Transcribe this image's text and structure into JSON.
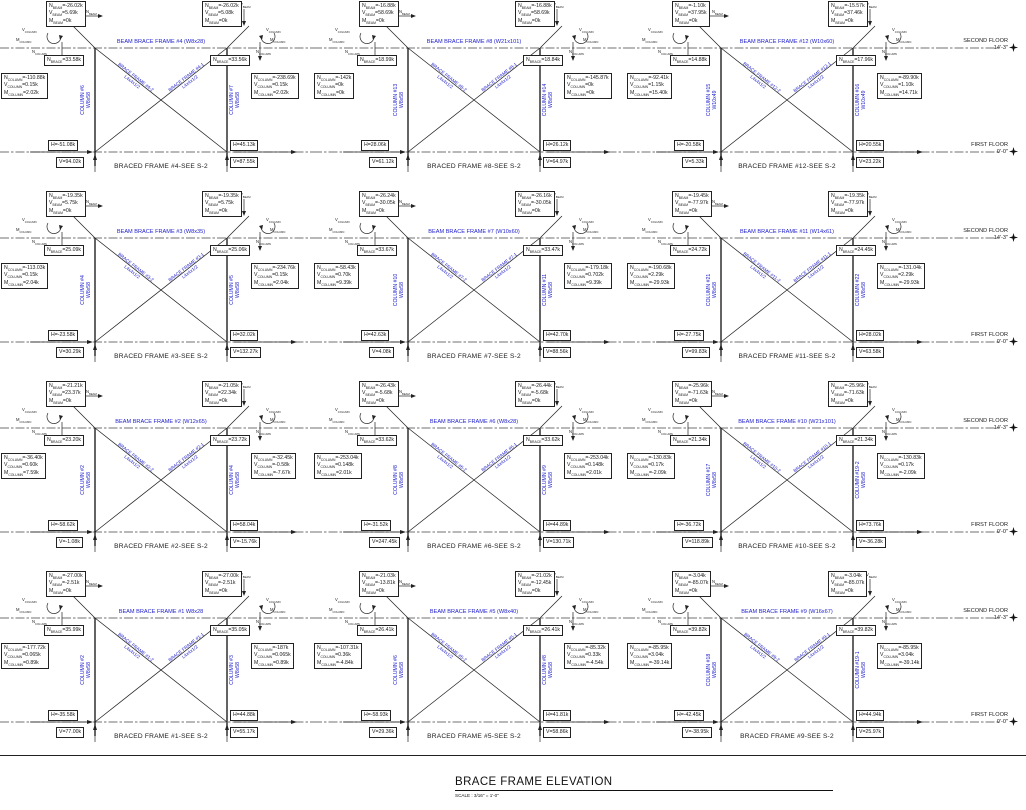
{
  "colors": {
    "label_blue": "#2222cc",
    "line_black": "#222222"
  },
  "sheet": {
    "title": "BRACE FRAME ELEVATION",
    "scale": "SCALE : 3/16\" = 1'-0\""
  },
  "floors": {
    "second": "SECOND FLOOR",
    "second_elev": "14'-3\"",
    "first": "FIRST FLOOR",
    "first_elev": "0'-0\""
  },
  "symbols": {
    "v_beam": "V_BEAM",
    "n_beam": "N_BEAM",
    "v_column": "V_COLUMN",
    "m_column": "M_COLUMN",
    "n_column": "N_COLUMN"
  },
  "frames": [
    {
      "beam_label": "BEAM BRACE FRAME #4 (W8x28)",
      "caption": "BRACED FRAME #4-SEE S-2",
      "left_column_label": "COLUMN #6",
      "left_column_size": "W8x58",
      "right_column_label": "COLUMN #7",
      "right_column_size": "W8x58",
      "left_brace_label": "BRACE FRAME #4-2",
      "left_brace_size": "L4x4x1/2",
      "right_brace_label": "BRACE FRAME #4-1",
      "right_brace_size": "L4x4x1/2",
      "beam_box_left": [
        "N_BEAM=-26.02k",
        "V_BEAM=5.69k",
        "M_BEAM=0k"
      ],
      "beam_box_right": [
        "N_BEAM=-26.02k",
        "V_BEAM=5.08k",
        "M_BEAM=0k"
      ],
      "brace_left": "N_BRACE=33.58k",
      "brace_right": "N_BRACE=33.56k",
      "column_box_left": [
        "N_COLUMN=-110.88k",
        "V_COLUMN=0.15k",
        "M_COLUMN=2.02k"
      ],
      "column_box_right": [
        "N_COLUMN=-238.69k",
        "V_COLUMN=0.15k",
        "M_COLUMN=2.02k"
      ],
      "h_left": "H=-51.08k",
      "h_right": "H=45.13k",
      "v_left": "V=94.02k",
      "v_right": "V=87.55k"
    },
    {
      "beam_label": "BEAM BRACE FRAME #8 (W21x101)",
      "caption": "BRACED FRAME #8-SEE S-2",
      "left_column_label": "COLUMN #13",
      "left_column_size": "W8x58",
      "right_column_label": "COLUMN #14",
      "right_column_size": "W8x58",
      "left_brace_label": "BRACE FRAME #8-2",
      "left_brace_size": "L4x4x1/2",
      "right_brace_label": "BRACE FRAME #8-1",
      "right_brace_size": "L4x4x1/2",
      "beam_box_left": [
        "N_BEAM=-16.88k",
        "V_BEAM=58.69k",
        "M_BEAM=0k"
      ],
      "beam_box_right": [
        "N_BEAM=-16.88k",
        "V_BEAM=58.69k",
        "M_BEAM=0k"
      ],
      "brace_left": "N_BRACE=18.99k",
      "brace_right": "N_BRACE=18.84k",
      "column_box_left": [
        "N_COLUMN=-142k",
        "V_COLUMN=0k",
        "M_COLUMN=0k"
      ],
      "column_box_right": [
        "N_COLUMN=-145.87k",
        "V_COLUMN=0k",
        "M_COLUMN=0k"
      ],
      "h_left": "H=28.06k",
      "h_right": "H=26.12k",
      "v_left": "V=61.12k",
      "v_right": "V=64.97k"
    },
    {
      "beam_label": "BEAM BRACE FRAME #12 (W10x60)",
      "caption": "BRACED FRAME #12-SEE S-2",
      "left_column_label": "COLUMN #15",
      "left_column_size": "W10x49",
      "right_column_label": "COLUMN #16",
      "right_column_size": "W10x49",
      "left_brace_label": "BRACE FRAME #12-2",
      "left_brace_size": "L4x4x1/2",
      "right_brace_label": "BRACE FRAME #12-1",
      "right_brace_size": "L4x4x1/2",
      "beam_box_left": [
        "N_BEAM=-1.10k",
        "V_BEAM=37.95k",
        "M_BEAM=0k"
      ],
      "beam_box_right": [
        "N_BEAM=-15.57k",
        "V_BEAM=37.46k",
        "M_BEAM=0k"
      ],
      "brace_left": "N_BRACE=14.88k",
      "brace_right": "N_BRACE=17.96k",
      "column_box_left": [
        "N_COLUMN=-92.41k",
        "V_COLUMN=1.15k",
        "M_COLUMN=15.40k"
      ],
      "column_box_right": [
        "N_COLUMN=-89.90k",
        "V_COLUMN=1.10k",
        "M_COLUMN=14.71k"
      ],
      "h_left": "H=-20.58k",
      "h_right": "H=20.55k",
      "v_left": "V=5.33k",
      "v_right": "V=23.22k"
    },
    {
      "beam_label": "BEAM BRACE FRAME #3 (W8x35)",
      "caption": "BRACED FRAME #3-SEE S-2",
      "left_column_label": "COLUMN #4",
      "left_column_size": "W8x58",
      "right_column_label": "COLUMN #5",
      "right_column_size": "W8x58",
      "left_brace_label": "BRACE FRAME #3-2",
      "left_brace_size": "L4x4x1/2",
      "right_brace_label": "BRACE FRAME #3-1",
      "right_brace_size": "L4x4x1/2",
      "beam_box_left": [
        "N_BEAM=-19.35k",
        "V_BEAM=5.75k",
        "M_BEAM=0k"
      ],
      "beam_box_right": [
        "N_BEAM=-19.35k",
        "V_BEAM=5.75k",
        "M_BEAM=0k"
      ],
      "brace_left": "N_BRACE=25.09k",
      "brace_right": "N_BRACE=25.06k",
      "column_box_left": [
        "N_COLUMN=-113.03k",
        "V_COLUMN=0.15k",
        "M_COLUMN=2.04k"
      ],
      "column_box_right": [
        "N_COLUMN=-234.76k",
        "V_COLUMN=0.15k",
        "M_COLUMN=2.04k"
      ],
      "h_left": "H=-23.58k",
      "h_right": "H=32.02k",
      "v_left": "V=30.29k",
      "v_right": "V=132.27k"
    },
    {
      "beam_label": "BEAM BRACE FRAME #7 (W10x60)",
      "caption": "BRACED FRAME #7-SEE S-2",
      "left_column_label": "COLUMN #10",
      "left_column_size": "W8x58",
      "right_column_label": "COLUMN #11",
      "right_column_size": "W8x58",
      "left_brace_label": "BRACE FRAME #7-2",
      "left_brace_size": "L4x4x1/2",
      "right_brace_label": "BRACE FRAME #7-1",
      "right_brace_size": "L4x4x1/2",
      "beam_box_left": [
        "N_BEAM=-26.24k",
        "V_BEAM=-30.05k",
        "M_BEAM=0k"
      ],
      "beam_box_right": [
        "N_BEAM=-26.16k",
        "V_BEAM=-30.05k",
        "M_BEAM=0k"
      ],
      "brace_left": "N_BRACE=33.67k",
      "brace_right": "N_BRACE=33.47k",
      "column_box_left": [
        "N_COLUMN=-58.43k",
        "V_COLUMN=0.70k",
        "M_COLUMN=9.39k"
      ],
      "column_box_right": [
        "N_COLUMN=-179.18k",
        "V_COLUMN=0.702k",
        "M_COLUMN=9.39k"
      ],
      "h_left": "H=42.63k",
      "h_right": "H=42.70k",
      "v_left": "V=4.08k",
      "v_right": "V=88.56k"
    },
    {
      "beam_label": "BEAM BRACE FRAME #11 (W14x61)",
      "caption": "BRACED FRAME #11-SEE S-2",
      "left_column_label": "COLUMN #21",
      "left_column_size": "W8x58",
      "right_column_label": "COLUMN #22",
      "right_column_size": "W8x58",
      "left_brace_label": "BRACE FRAME #11-2",
      "left_brace_size": "L4x4x1/2",
      "right_brace_label": "BRACE FRAME #11-1",
      "right_brace_size": "L4x4x1/2",
      "beam_box_left": [
        "N_BEAM=-19.45k",
        "V_BEAM=-77.97k",
        "M_BEAM=0k"
      ],
      "beam_box_right": [
        "N_BEAM=-19.35k",
        "V_BEAM=-77.97k",
        "M_BEAM=0k"
      ],
      "brace_left": "N_BRACE=24.72k",
      "brace_right": "N_BRACE=24.45k",
      "column_box_left": [
        "N_COLUMN=-190.68k",
        "V_COLUMN=2.29k",
        "M_COLUMN=-29.93k"
      ],
      "column_box_right": [
        "N_COLUMN=-131.04k",
        "V_COLUMN=2.29k",
        "M_COLUMN=-29.93k"
      ],
      "h_left": "H=-27.75k",
      "h_right": "H=28.02k",
      "v_left": "V=99.83k",
      "v_right": "V=63.58k"
    },
    {
      "beam_label": "BEAM BRACE FRAME #2 (W12x65)",
      "caption": "BRACED FRAME #2-SEE S-2",
      "left_column_label": "COLUMN #2",
      "left_column_size": "W8x58",
      "right_column_label": "COLUMN #4",
      "right_column_size": "W8x58",
      "left_brace_label": "BRACE FRAME #2-2",
      "left_brace_size": "L4x4x1/2",
      "right_brace_label": "BRACE FRAME #2-1",
      "right_brace_size": "L4x4x1/2",
      "beam_box_left": [
        "N_BEAM=-21.21k",
        "V_BEAM=23.37k",
        "M_BEAM=0k"
      ],
      "beam_box_right": [
        "N_BEAM=-21.05k",
        "V_BEAM=22.34k",
        "M_BEAM=0k"
      ],
      "brace_left": "N_BRACE=23.20k",
      "brace_right": "N_BRACE=23.72k",
      "column_box_left": [
        "N_COLUMN=-36.40k",
        "V_COLUMN=0.60k",
        "M_COLUMN=7.59k"
      ],
      "column_box_right": [
        "N_COLUMN=-32.45k",
        "V_COLUMN=-0.58k",
        "M_COLUMN=-7.67k"
      ],
      "h_left": "H=-58.62k",
      "h_right": "H=58.04k",
      "v_left": "V=-1.08k",
      "v_right": "V=-15.76k"
    },
    {
      "beam_label": "BEAM BRACE FRAME #6 (W8x28)",
      "caption": "BRACED FRAME #6-SEE S-2",
      "left_column_label": "COLUMN #8",
      "left_column_size": "W8x58",
      "right_column_label": "COLUMN #9",
      "right_column_size": "W8x58",
      "left_brace_label": "BRACE FRAME #6-2",
      "left_brace_size": "L4x4x1/2",
      "right_brace_label": "BRACE FRAME #6-1",
      "right_brace_size": "L4x4x1/2",
      "beam_box_left": [
        "N_BEAM=-26.43k",
        "V_BEAM=-5.68k",
        "M_BEAM=0k"
      ],
      "beam_box_right": [
        "N_BEAM=-26.44k",
        "V_BEAM=-5.68k",
        "M_BEAM=0k"
      ],
      "brace_left": "N_BRACE=33.62k",
      "brace_right": "N_BRACE=33.62k",
      "column_box_left": [
        "N_COLUMN=-253.04k",
        "V_COLUMN=0.148k",
        "M_COLUMN=2.01k"
      ],
      "column_box_right": [
        "N_COLUMN=-253.04k",
        "V_COLUMN=0.148k",
        "M_COLUMN=2.01k"
      ],
      "h_left": "H=-31.52k",
      "h_right": "H=44.89k",
      "v_left": "V=247.45k",
      "v_right": "V=130.71k"
    },
    {
      "beam_label": "BEAM BRACE FRAME #10 (W21x101)",
      "caption": "BRACED FRAME #10-SEE S-2",
      "left_column_label": "COLUMN #17",
      "left_column_size": "W8x58",
      "right_column_label": "COLUMN #19-2",
      "right_column_size": "W8x58",
      "left_brace_label": "BRACE FRAME #10-2",
      "left_brace_size": "L4x4x1/2",
      "right_brace_label": "BRACE FRAME #10-1",
      "right_brace_size": "L4x4x1/2",
      "beam_box_left": [
        "N_BEAM=-25.96k",
        "V_BEAM=-71.63k",
        "M_BEAM=0k"
      ],
      "beam_box_right": [
        "N_BEAM=-25.96k",
        "V_BEAM=-71.63k",
        "M_BEAM=0k"
      ],
      "brace_left": "N_BRACE=21.34k",
      "brace_right": "N_BRACE=21.34k",
      "column_box_left": [
        "N_COLUMN=-130.83k",
        "V_COLUMN=0.17k",
        "M_COLUMN=-2.09k"
      ],
      "column_box_right": [
        "N_COLUMN=-130.83k",
        "V_COLUMN=0.17k",
        "M_COLUMN=-2.09k"
      ],
      "h_left": "H=-36.72k",
      "h_right": "H=73.76k",
      "v_left": "V=118.89k",
      "v_right": "V=-36.28k"
    },
    {
      "beam_label": "BEAM BRACE FRAME #1 W8x28",
      "caption": "BRACED FRAME #1-SEE S-2",
      "left_column_label": "COLUMN #2",
      "left_column_size": "W8x58",
      "right_column_label": "COLUMN #3",
      "right_column_size": "W8x58",
      "left_brace_label": "BRACE FRAME #1-2",
      "left_brace_size": "L4x4x1/2",
      "right_brace_label": "BRACE FRAME #1-1",
      "right_brace_size": "L4x4x1/2",
      "beam_box_left": [
        "N_BEAM=-27.00k",
        "V_BEAM=-2.51k",
        "M_BEAM=0k"
      ],
      "beam_box_right": [
        "N_BEAM=-27.00k",
        "V_BEAM=-2.51k",
        "M_BEAM=0k"
      ],
      "brace_left": "N_BRACE=35.99k",
      "brace_right": "N_BRACE=35.05k",
      "column_box_left": [
        "N_COLUMN=-177.72k",
        "V_COLUMN=0.065k",
        "M_COLUMN=0.89k"
      ],
      "column_box_right": [
        "N_COLUMN=-187k",
        "V_COLUMN=0.065k",
        "M_COLUMN=0.89k"
      ],
      "h_left": "H=-35.58k",
      "h_right": "H=44.88k",
      "v_left": "V=77.00k",
      "v_right": "V=55.17k"
    },
    {
      "beam_label": "BEAM BRACE FRAME #5 (W8x40)",
      "caption": "BRACED FRAME #5-SEE S-2",
      "left_column_label": "COLUMN #6",
      "left_column_size": "W8x58",
      "right_column_label": "COLUMN #8",
      "right_column_size": "W8x58",
      "left_brace_label": "BRACE FRAME #5-2",
      "left_brace_size": "L4x4x1/2",
      "right_brace_label": "BRACE FRAME #5-1",
      "right_brace_size": "L4x4x1/2",
      "beam_box_left": [
        "N_BEAM=-21.03k",
        "V_BEAM=-13.81k",
        "M_BEAM=0k"
      ],
      "beam_box_right": [
        "N_BEAM=-21.02k",
        "V_BEAM=-12.45k",
        "M_BEAM=0k"
      ],
      "brace_left": "N_BRACE=26.41k",
      "brace_right": "N_BRACE=26.41k",
      "column_box_left": [
        "N_COLUMN=-107.31k",
        "V_COLUMN=0.36k",
        "M_COLUMN=-4.84k"
      ],
      "column_box_right": [
        "N_COLUMN=-85.32k",
        "V_COLUMN=0.33k",
        "M_COLUMN=-4.54k"
      ],
      "h_left": "H=-58.93k",
      "h_right": "H=41.81k",
      "v_left": "V=29.36k",
      "v_right": "V=58.86k"
    },
    {
      "beam_label": "BEAM BRACE FRAME #9 (W16x67)",
      "caption": "BRACED FRAME #9-SEE S-2",
      "left_column_label": "COLUMN #18",
      "left_column_size": "W8x58",
      "right_column_label": "COLUMN #19-1",
      "right_column_size": "W8x58",
      "left_brace_label": "BRACE FRAME #9-2",
      "left_brace_size": "L4x4x1/2",
      "right_brace_label": "BRACE FRAME #9-1",
      "right_brace_size": "L4x4x1/2",
      "beam_box_left": [
        "N_BEAM=-3.04k",
        "V_BEAM=-85.07k",
        "M_BEAM=0k"
      ],
      "beam_box_right": [
        "N_BEAM=-3.04k",
        "V_BEAM=-85.07k",
        "M_BEAM=0k"
      ],
      "brace_left": "N_BRACE=39.82k",
      "brace_right": "N_BRACE=39.82k",
      "column_box_left": [
        "N_COLUMN=-85.95k",
        "V_COLUMN=3.04k",
        "M_COLUMN=-39.14k"
      ],
      "column_box_right": [
        "N_COLUMN=-85.95k",
        "V_COLUMN=3.04k",
        "M_COLUMN=-39.14k"
      ],
      "h_left": "H=-42.45k",
      "h_right": "H=44.94k",
      "v_left": "V=-38.95k",
      "v_right": "V=25.97k"
    }
  ]
}
